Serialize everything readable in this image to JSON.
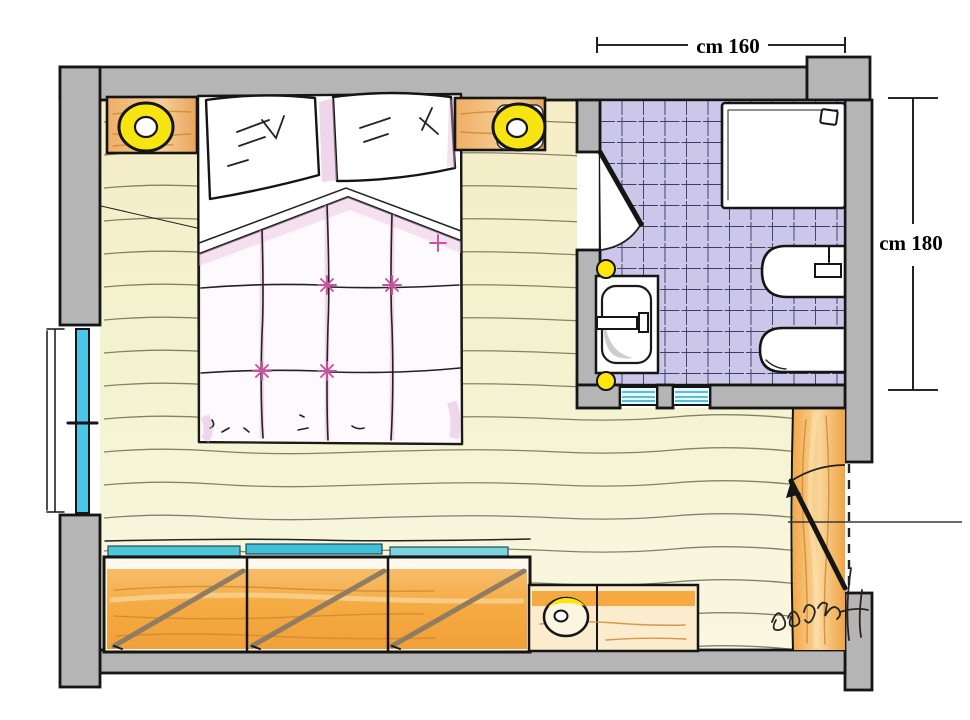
{
  "title": "Hand-drawn bedroom floor plan with en-suite bathroom",
  "dimensions": {
    "bathroom_width": {
      "label": "cm 160"
    },
    "bathroom_depth": {
      "label": "cm 180"
    }
  },
  "colors": {
    "paper": "#ffffff",
    "wall": "#b5b5b5",
    "outline": "#151515",
    "floor": "#f3f3d0",
    "floor-line": "#6e6e58",
    "wood": "#f3ab4e",
    "wood-light": "#f8d79e",
    "tile": "#cbc5e8",
    "tile-line": "#3f3f66",
    "glass": "#4cc7ea",
    "lamp": "#f8e411",
    "pink": "#c6539c"
  },
  "elements": {
    "rooms": [
      "bedroom",
      "bathroom"
    ],
    "fixtures": [
      "double-bed",
      "pillow-left",
      "pillow-right",
      "quilt",
      "nightstand-left",
      "nightstand-right",
      "lamp-left",
      "lamp-right",
      "wardrobe",
      "bench",
      "stool",
      "right-cabinet",
      "shower-tray",
      "shower-drain",
      "washbasin",
      "basin-tap",
      "bidet",
      "toilet",
      "wall-light-upper",
      "wall-light-lower",
      "window",
      "glass-panel-left",
      "glass-panel-right",
      "bathroom-door",
      "entry-door",
      "mosaic-tile-floor",
      "wood-plank-floor",
      "artist-signature"
    ]
  }
}
